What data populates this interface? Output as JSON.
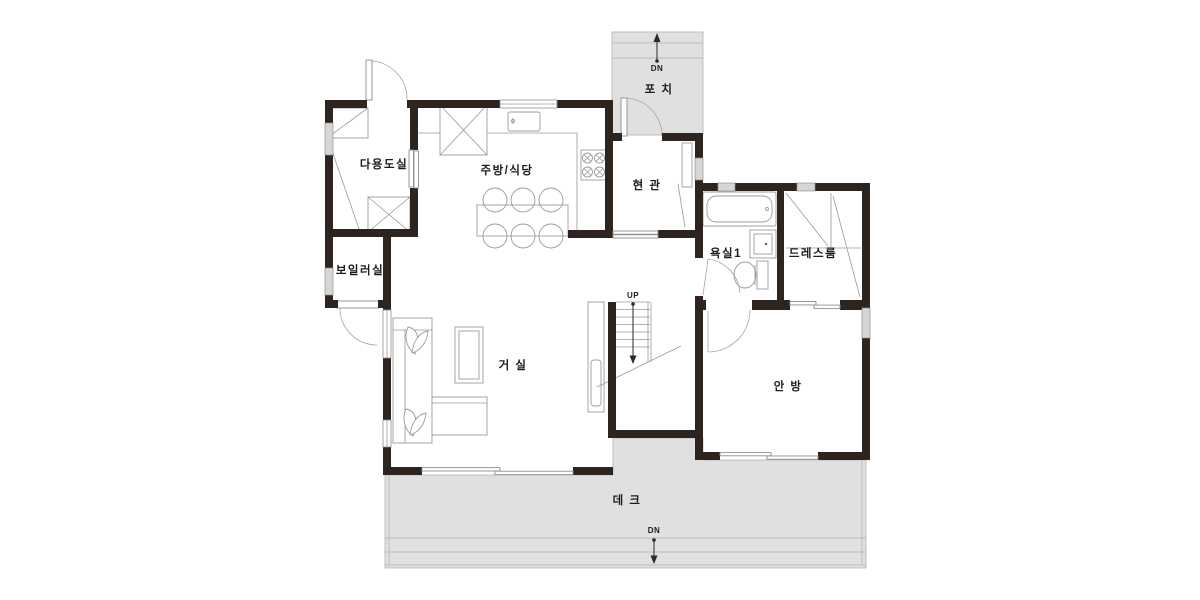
{
  "title": "residential-floor-plan",
  "colors": {
    "wall": "#2d2420",
    "deck": "#e0e0e0",
    "line": "#9a9a9a",
    "text": "#1c1c1c",
    "bg": "#ffffff"
  },
  "rooms": {
    "utility": {
      "label": "다용도실"
    },
    "kitchen": {
      "label": "주방/식당"
    },
    "entrance": {
      "label": "현 관"
    },
    "porch": {
      "label": "포 치"
    },
    "bathroom1": {
      "label": "욕실1"
    },
    "dressroom": {
      "label": "드레스룸"
    },
    "boiler": {
      "label": "보일러실"
    },
    "living": {
      "label": "거 실"
    },
    "master": {
      "label": "안 방"
    },
    "deck": {
      "label": "데 크"
    }
  },
  "markers": {
    "up": "UP",
    "dn": "DN"
  }
}
